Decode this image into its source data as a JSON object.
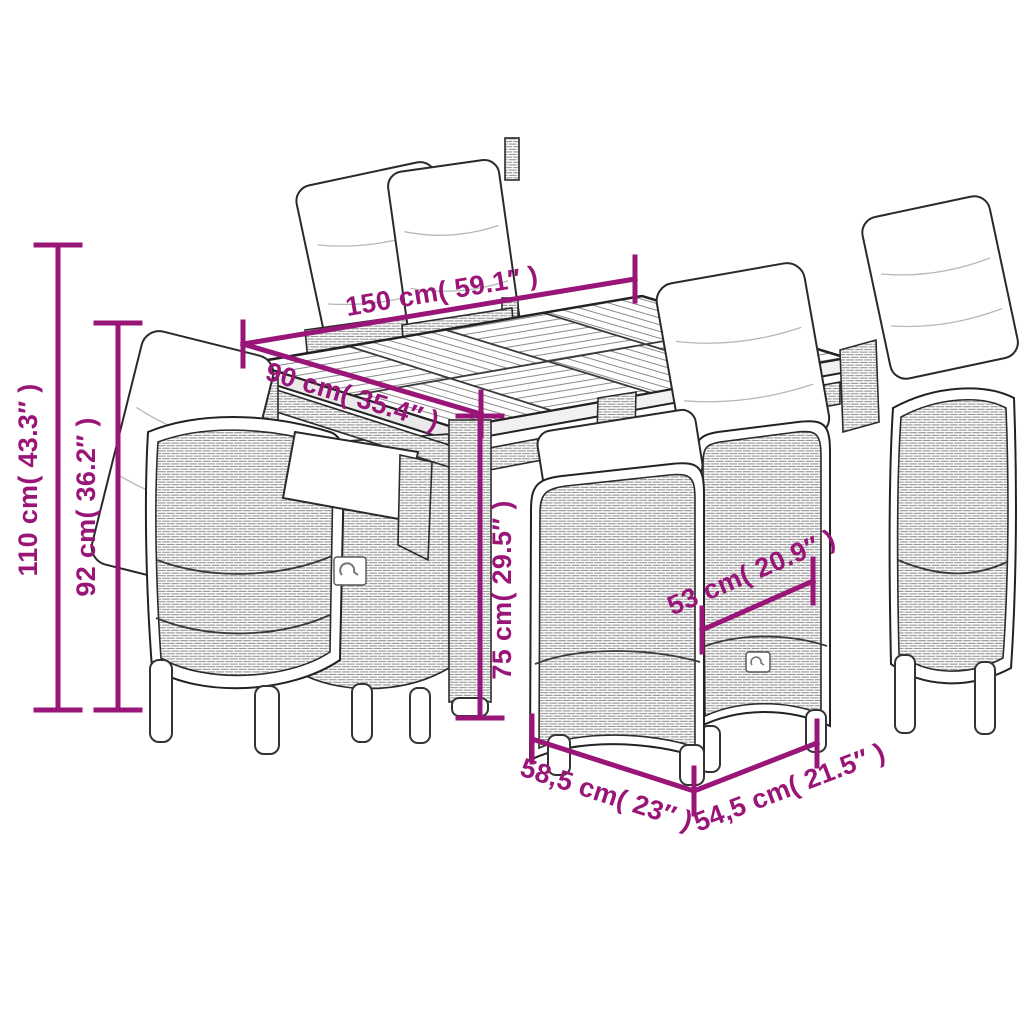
{
  "page": {
    "background": "#ffffff",
    "width": 1024,
    "height": 1024
  },
  "diagram": {
    "kind": "furniture-dimension-line-art",
    "subject": "garden dining set: slatted-top table with six cushioned poly-rattan reclining chairs",
    "colors": {
      "dimension_accent": "#9A1578",
      "outline": "#222222",
      "wicker_weave": "#8f8f8f",
      "cushion": "#ffffff"
    },
    "measurements": [
      {
        "name": "table-length",
        "label": "150 cm( 59.1″ )"
      },
      {
        "name": "table-width",
        "label": "90 cm( 35.4″ )"
      },
      {
        "name": "overall-height",
        "label": "110 cm( 43.3″ )"
      },
      {
        "name": "backrest-height",
        "label": "92 cm( 36.2″ )"
      },
      {
        "name": "table-height",
        "label": "75 cm( 29.5″ )"
      },
      {
        "name": "seat-width",
        "label": "53 cm( 20.9″ )"
      },
      {
        "name": "chair-depth",
        "label": "58,5 cm( 23″ )"
      },
      {
        "name": "chair-width",
        "label": "54,5 cm( 21.5″ )"
      }
    ]
  }
}
